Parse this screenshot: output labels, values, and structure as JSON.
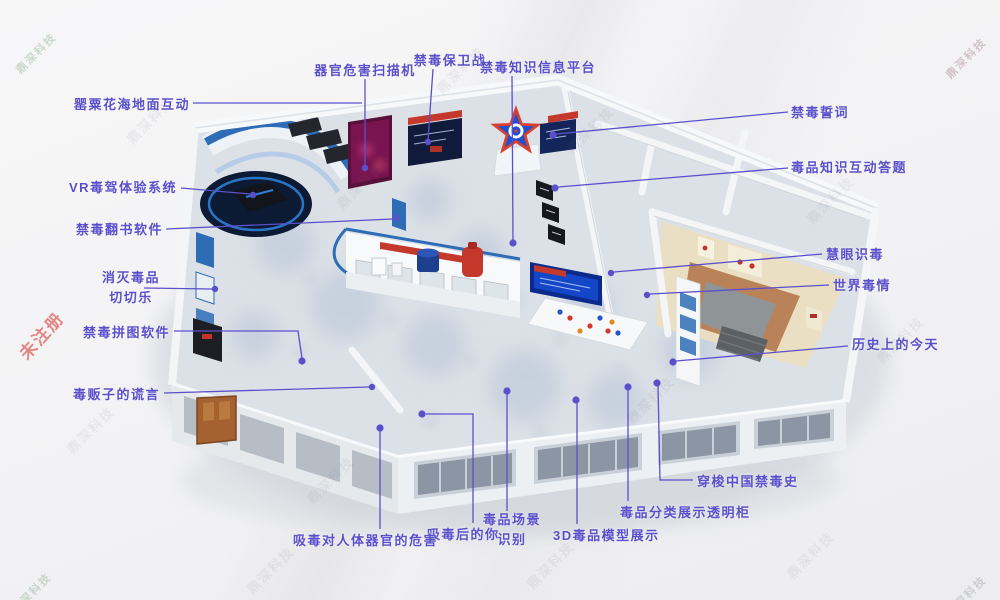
{
  "watermarks": {
    "tiled": "鼎深科技",
    "unregistered": "未注册"
  },
  "labels": [
    {
      "id": "poppy-sea-floor",
      "text": "罂粟花海地面互动"
    },
    {
      "id": "organ-scanner",
      "text": "器官危害扫描机"
    },
    {
      "id": "anti-drug-battle",
      "text": "禁毒保卫战"
    },
    {
      "id": "knowledge-platform",
      "text": "禁毒知识信息平台"
    },
    {
      "id": "anti-drug-pledge",
      "text": "禁毒誓词"
    },
    {
      "id": "knowledge-quiz",
      "text": "毒品知识互动答题"
    },
    {
      "id": "vr-drugged-driving",
      "text": "VR毒驾体验系统"
    },
    {
      "id": "book-flipping",
      "text": "禁毒翻书软件"
    },
    {
      "id": "eliminate-drugs",
      "text": "消灭毒品\n切切乐"
    },
    {
      "id": "jigsaw-software",
      "text": "禁毒拼图软件"
    },
    {
      "id": "dealer-lies",
      "text": "毒贩子的谎言"
    },
    {
      "id": "sharp-eye-identify",
      "text": "慧眼识毒"
    },
    {
      "id": "world-drug-situation",
      "text": "世界毒情"
    },
    {
      "id": "today-in-history",
      "text": "历史上的今天"
    },
    {
      "id": "china-drug-history",
      "text": "穿梭中国禁毒史"
    },
    {
      "id": "transparent-cabinet",
      "text": "毒品分类展示透明柜"
    },
    {
      "id": "3d-drug-models",
      "text": "3D毒品模型展示"
    },
    {
      "id": "scene-recognition",
      "text": "毒品场景\n识别"
    },
    {
      "id": "you-after-drugs",
      "text": "吸毒后的你"
    },
    {
      "id": "organ-harm",
      "text": "吸毒对人体器官的危害"
    }
  ],
  "colors": {
    "label": "#5b50cb",
    "accent_blue": "#2e6cb5",
    "star_red": "#d8402f",
    "star_blue": "#2050d0",
    "red_banner": "#c5392c",
    "vr_platform": "#0c1a33",
    "beige_room": "#eadfc2",
    "terracotta": "#b57a50",
    "door_brown": "#a5612f"
  }
}
